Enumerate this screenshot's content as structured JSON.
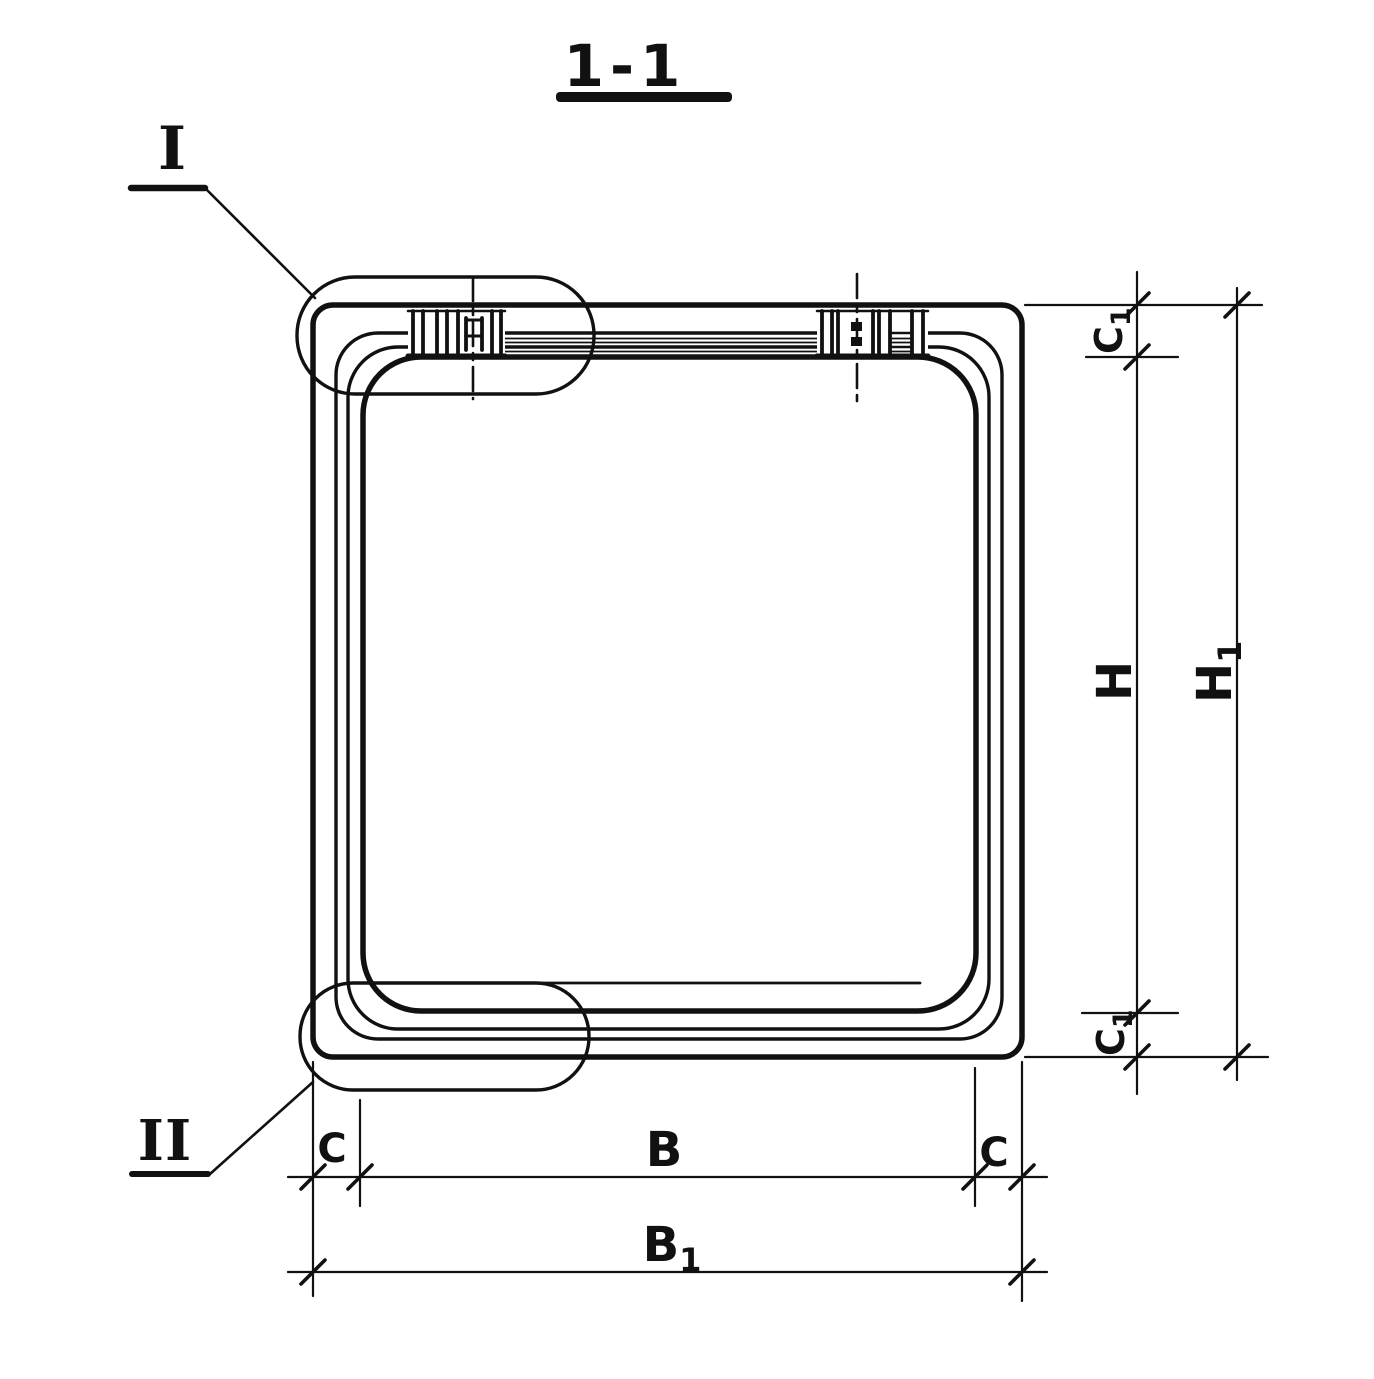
{
  "drawing": {
    "title": "1-1",
    "ink_color": "#111111",
    "paper_color": "#ffffff",
    "details": [
      {
        "label": "I"
      },
      {
        "label": "II"
      }
    ],
    "dims_right": [
      {
        "main": "C",
        "sub": "1"
      },
      {
        "main": "H",
        "sub": ""
      },
      {
        "main": "H",
        "sub": "1"
      },
      {
        "main": "C",
        "sub": "1"
      }
    ],
    "dims_bottom": [
      {
        "main": "C",
        "sub": ""
      },
      {
        "main": "B",
        "sub": ""
      },
      {
        "main": "C",
        "sub": ""
      },
      {
        "main": "B",
        "sub": "1"
      }
    ]
  }
}
